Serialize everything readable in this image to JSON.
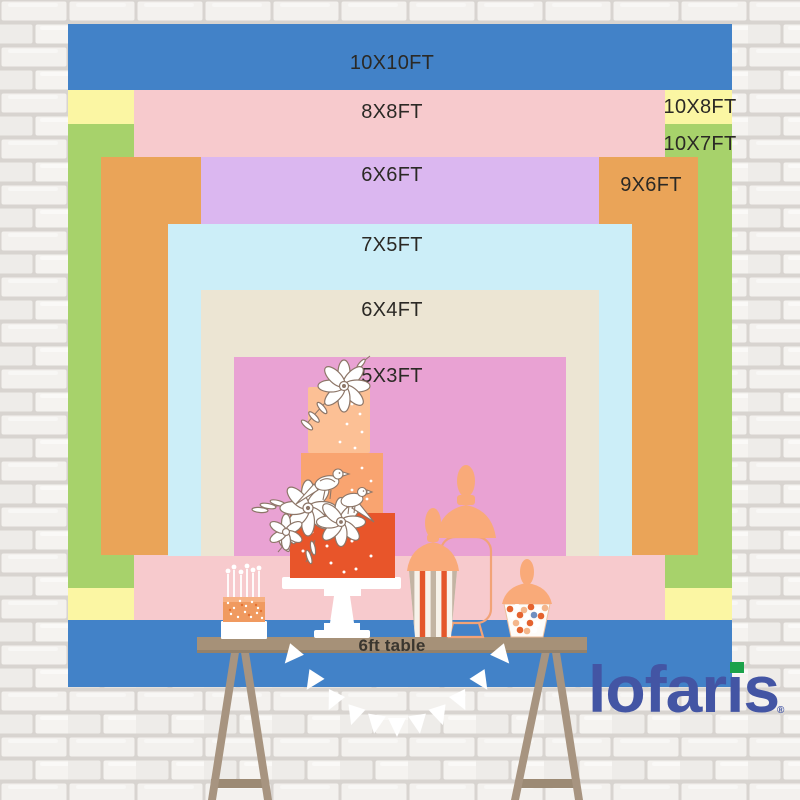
{
  "backdrop": {
    "layers": [
      {
        "id": "10x10",
        "label": "10X10FT",
        "color": "#4282c8"
      },
      {
        "id": "10x8",
        "label": "10X8FT",
        "color": "#fbf6a3"
      },
      {
        "id": "10x7",
        "label": "10X7FT",
        "color": "#a7d26b"
      },
      {
        "id": "8x8",
        "label": "8X8FT",
        "color": "#f7cacd"
      },
      {
        "id": "9x6",
        "label": "9X6FT",
        "color": "#eaa458"
      },
      {
        "id": "6x6",
        "label": "6X6FT",
        "color": "#dbb7f0"
      },
      {
        "id": "7x5",
        "label": "7X5FT",
        "color": "#cceef8"
      },
      {
        "id": "6x4",
        "label": "6X4FT",
        "color": "#ece5d3"
      },
      {
        "id": "5x3",
        "label": "5X3FT",
        "color": "#e9a2d3"
      }
    ],
    "label_color": "#2b2925"
  },
  "table": {
    "label": "6ft table",
    "color": "#a69178"
  },
  "logo": {
    "text": "lofaris",
    "registered": "®",
    "color": "#4355a4",
    "dot_color": "#1ba24a"
  }
}
